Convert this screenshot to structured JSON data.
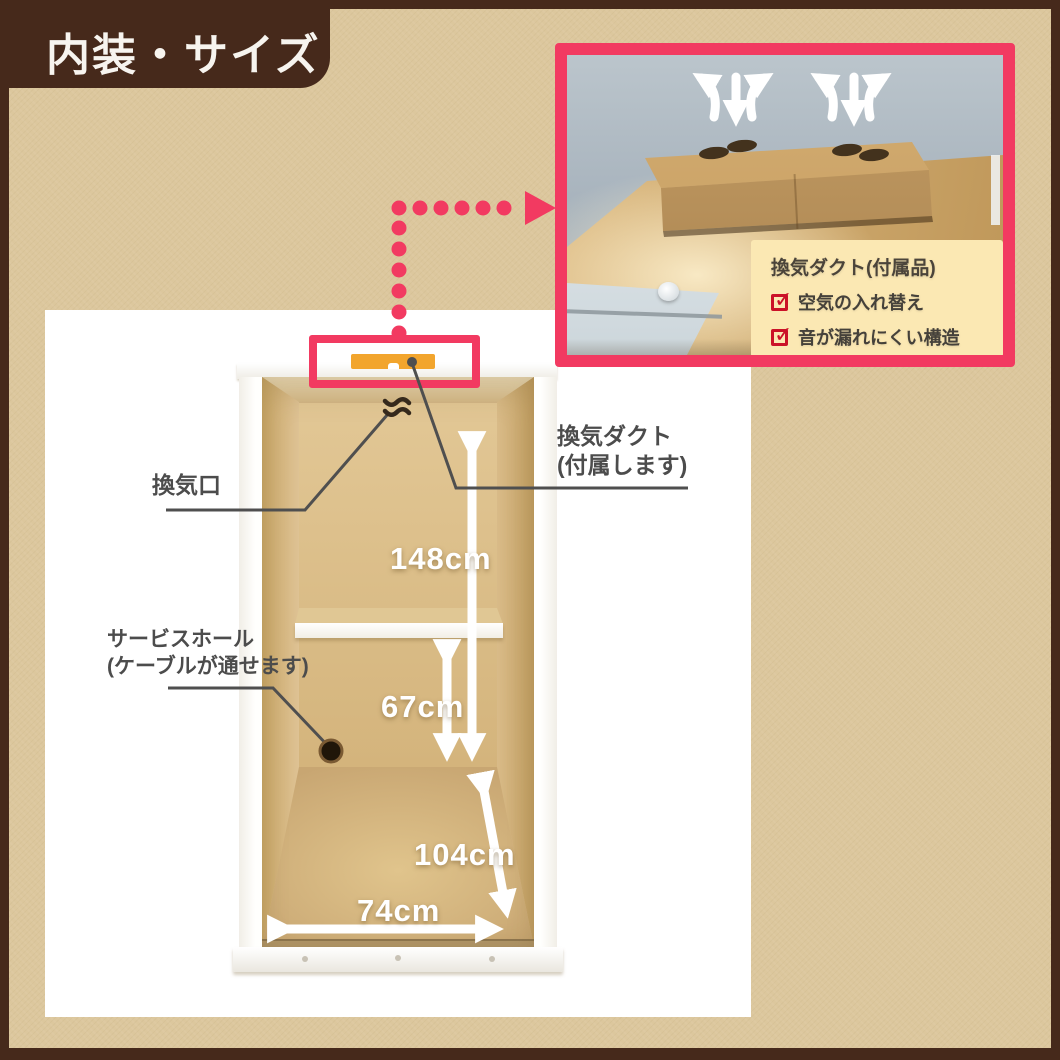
{
  "title_badge": {
    "label": "内装・サイズ"
  },
  "palette": {
    "frame_brown": "#46291b",
    "background_tan": "#dcc79d",
    "accent_pink": "#f23a61",
    "duct_orange": "#f2a52d",
    "cardboard_tan": "#d9b87f",
    "check_red": "#cb1228",
    "callout_yellow": "#fbe8b3",
    "label_gray": "#4c4c4c"
  },
  "diagram": {
    "labels": {
      "vent_opening": "換気口",
      "vent_duct_line1": "換気ダクト",
      "vent_duct_line2": "(付属します)",
      "service_hole_line1": "サービスホール",
      "service_hole_line2": "(ケーブルが通せます)"
    },
    "measurements": {
      "interior_height": "148cm",
      "under_shelf_height": "67cm",
      "floor_depth": "104cm",
      "floor_width": "74cm"
    }
  },
  "inset": {
    "callout": {
      "title": "換気ダクト(付属品)",
      "items": [
        {
          "label": "空気の入れ替え"
        },
        {
          "label": "音が漏れにくい構造"
        }
      ]
    }
  }
}
